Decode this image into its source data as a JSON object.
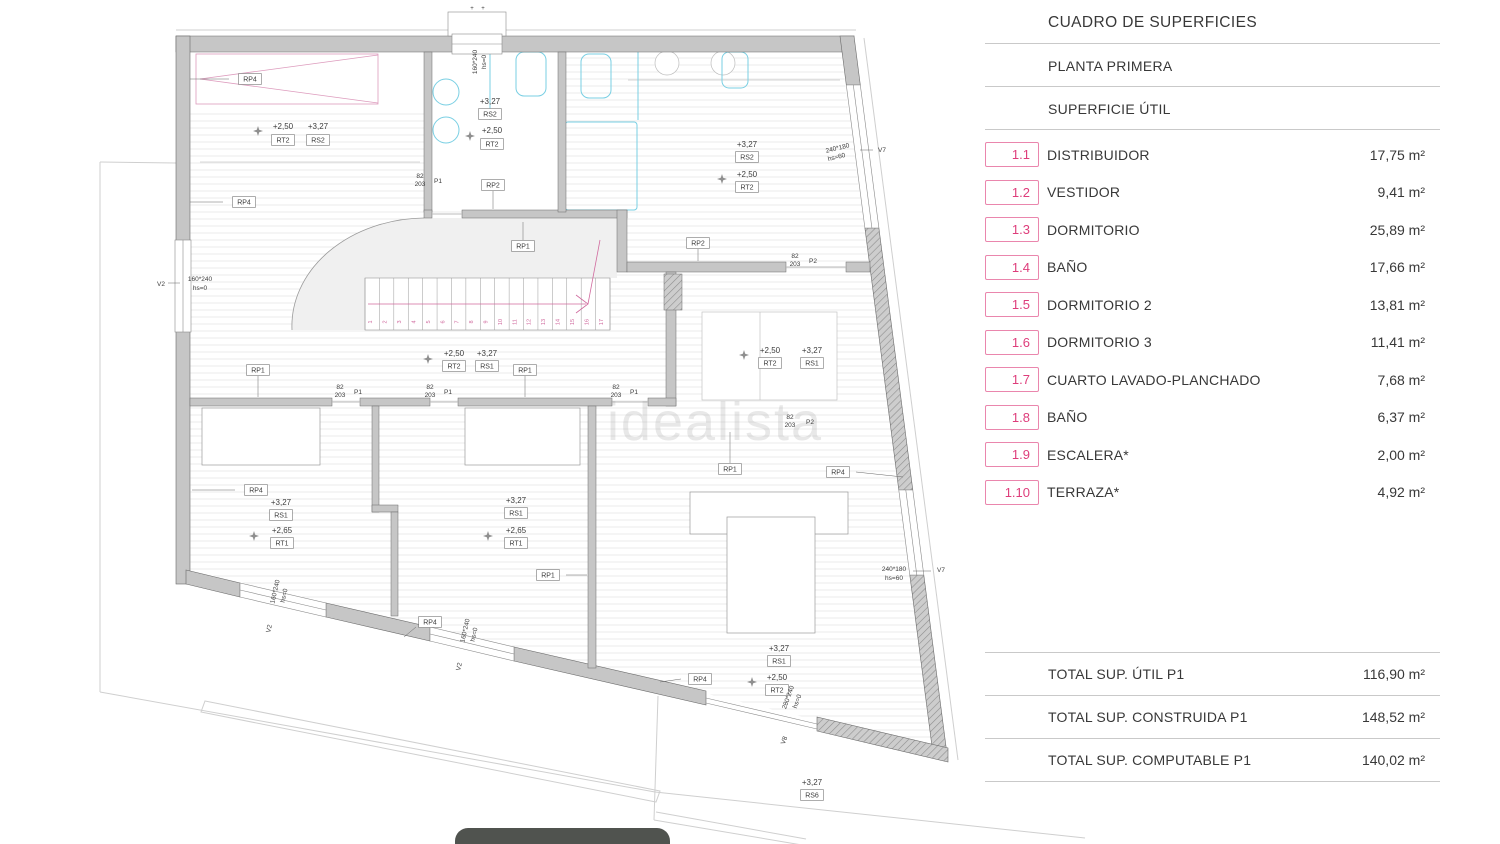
{
  "panel": {
    "title": "CUADRO DE SUPERFICIES",
    "subtitle": "PLANTA PRIMERA",
    "section": "SUPERFICIE ÚTIL",
    "accent_color": "#de3d7b",
    "rows": [
      {
        "code": "1.1",
        "label": "DISTRIBUIDOR",
        "value": "17,75 m²"
      },
      {
        "code": "1.2",
        "label": "VESTIDOR",
        "value": "9,41 m²"
      },
      {
        "code": "1.3",
        "label": "DORMITORIO",
        "value": "25,89 m²"
      },
      {
        "code": "1.4",
        "label": "BAÑO",
        "value": "17,66 m²"
      },
      {
        "code": "1.5",
        "label": "DORMITORIO 2",
        "value": "13,81 m²"
      },
      {
        "code": "1.6",
        "label": "DORMITORIO 3",
        "value": "11,41 m²"
      },
      {
        "code": "1.7",
        "label": "CUARTO LAVADO-PLANCHADO",
        "value": "7,68 m²"
      },
      {
        "code": "1.8",
        "label": "BAÑO",
        "value": "6,37 m²"
      },
      {
        "code": "1.9",
        "label": "ESCALERA*",
        "value": "2,00 m²"
      },
      {
        "code": "1.10",
        "label": "TERRAZA*",
        "value": "4,92 m²"
      }
    ],
    "totals": [
      {
        "label": "TOTAL SUP. ÚTIL P1",
        "value": "116,90 m²"
      },
      {
        "label": "TOTAL SUP. CONSTRUIDA P1",
        "value": "148,52 m²"
      },
      {
        "label": "TOTAL SUP. COMPUTABLE P1",
        "value": "140,02 m²"
      }
    ]
  },
  "plan": {
    "watermark": "idealista",
    "stairs": {
      "numbers": [
        1,
        2,
        3,
        4,
        5,
        6,
        7,
        8,
        9,
        10,
        11,
        12,
        13,
        14,
        15,
        16,
        17
      ]
    },
    "boxes": [
      {
        "t": "RP4",
        "x": 250,
        "y": 79
      },
      {
        "t": "RP4",
        "x": 244,
        "y": 202
      },
      {
        "t": "RP4",
        "x": 256,
        "y": 490
      },
      {
        "t": "RP4",
        "x": 700,
        "y": 679
      },
      {
        "t": "RP4",
        "x": 838,
        "y": 472
      },
      {
        "t": "RP4",
        "x": 430,
        "y": 622
      },
      {
        "t": "RP1",
        "x": 523,
        "y": 246
      },
      {
        "t": "RP1",
        "x": 258,
        "y": 370
      },
      {
        "t": "RP1",
        "x": 525,
        "y": 370
      },
      {
        "t": "RP1",
        "x": 548,
        "y": 575
      },
      {
        "t": "RP1",
        "x": 730,
        "y": 469
      },
      {
        "t": "RP2",
        "x": 493,
        "y": 185
      },
      {
        "t": "RP2",
        "x": 698,
        "y": 243
      },
      {
        "t": "RT2",
        "x": 283,
        "y": 140
      },
      {
        "t": "RT2",
        "x": 492,
        "y": 144
      },
      {
        "t": "RT2",
        "x": 747,
        "y": 187
      },
      {
        "t": "RT2",
        "x": 454,
        "y": 366
      },
      {
        "t": "RT2",
        "x": 770,
        "y": 363
      },
      {
        "t": "RT2",
        "x": 777,
        "y": 690
      },
      {
        "t": "RS2",
        "x": 318,
        "y": 140
      },
      {
        "t": "RS2",
        "x": 490,
        "y": 114
      },
      {
        "t": "RS2",
        "x": 747,
        "y": 157
      },
      {
        "t": "RS1",
        "x": 487,
        "y": 366
      },
      {
        "t": "RS1",
        "x": 812,
        "y": 363
      },
      {
        "t": "RS1",
        "x": 281,
        "y": 515
      },
      {
        "t": "RS1",
        "x": 516,
        "y": 513
      },
      {
        "t": "RS1",
        "x": 779,
        "y": 661
      },
      {
        "t": "RT1",
        "x": 282,
        "y": 543
      },
      {
        "t": "RT1",
        "x": 516,
        "y": 543
      },
      {
        "t": "RS6",
        "x": 812,
        "y": 795
      }
    ],
    "texts": [
      {
        "t": "+2,50",
        "x": 283,
        "y": 129
      },
      {
        "t": "+2,50",
        "x": 492,
        "y": 133
      },
      {
        "t": "+2,50",
        "x": 747,
        "y": 177
      },
      {
        "t": "+2,50",
        "x": 454,
        "y": 356
      },
      {
        "t": "+2,50",
        "x": 770,
        "y": 353
      },
      {
        "t": "+2,50",
        "x": 777,
        "y": 680
      },
      {
        "t": "+3,27",
        "x": 318,
        "y": 129
      },
      {
        "t": "+3,27",
        "x": 490,
        "y": 104
      },
      {
        "t": "+3,27",
        "x": 747,
        "y": 147
      },
      {
        "t": "+3,27",
        "x": 487,
        "y": 356
      },
      {
        "t": "+3,27",
        "x": 812,
        "y": 353
      },
      {
        "t": "+3,27",
        "x": 281,
        "y": 505
      },
      {
        "t": "+3,27",
        "x": 516,
        "y": 503
      },
      {
        "t": "+3,27",
        "x": 779,
        "y": 651
      },
      {
        "t": "+3,27",
        "x": 812,
        "y": 785
      },
      {
        "t": "+2,65",
        "x": 282,
        "y": 533
      },
      {
        "t": "+2,65",
        "x": 516,
        "y": 533
      },
      {
        "t": "82",
        "x": 420,
        "y": 178,
        "s": 6.5
      },
      {
        "t": "203",
        "x": 420,
        "y": 186,
        "s": 6.5
      },
      {
        "t": "P1",
        "x": 438,
        "y": 183,
        "s": 6.5
      },
      {
        "t": "82",
        "x": 340,
        "y": 389,
        "s": 6.5
      },
      {
        "t": "203",
        "x": 340,
        "y": 397,
        "s": 6.5
      },
      {
        "t": "P1",
        "x": 358,
        "y": 394,
        "s": 6.5
      },
      {
        "t": "82",
        "x": 430,
        "y": 389,
        "s": 6.5
      },
      {
        "t": "203",
        "x": 430,
        "y": 397,
        "s": 6.5
      },
      {
        "t": "P1",
        "x": 448,
        "y": 394,
        "s": 6.5
      },
      {
        "t": "82",
        "x": 616,
        "y": 389,
        "s": 6.5
      },
      {
        "t": "203",
        "x": 616,
        "y": 397,
        "s": 6.5
      },
      {
        "t": "P1",
        "x": 634,
        "y": 394,
        "s": 6.5
      },
      {
        "t": "82",
        "x": 795,
        "y": 258,
        "s": 6.5
      },
      {
        "t": "203",
        "x": 795,
        "y": 266,
        "s": 6.5
      },
      {
        "t": "P2",
        "x": 813,
        "y": 263,
        "s": 6.5
      },
      {
        "t": "82",
        "x": 790,
        "y": 419,
        "s": 6.5
      },
      {
        "t": "203",
        "x": 790,
        "y": 427,
        "s": 6.5
      },
      {
        "t": "P2",
        "x": 810,
        "y": 424,
        "s": 6.5
      },
      {
        "t": "160*240",
        "x": 477,
        "y": 62,
        "r": -90,
        "s": 6.5
      },
      {
        "t": "hs=0",
        "x": 486,
        "y": 62,
        "r": -90,
        "s": 6.5
      },
      {
        "t": "160*240",
        "x": 200,
        "y": 281,
        "s": 6.5
      },
      {
        "t": "hs=0",
        "x": 200,
        "y": 290,
        "s": 6.5
      },
      {
        "t": "V2",
        "x": 161,
        "y": 286,
        "s": 6.5
      },
      {
        "t": "160*240",
        "x": 277,
        "y": 592,
        "r": -77,
        "s": 6.5
      },
      {
        "t": "hs=0",
        "x": 286,
        "y": 596,
        "r": -77,
        "s": 6.5
      },
      {
        "t": "V2",
        "x": 271,
        "y": 629,
        "r": -77,
        "s": 6.5
      },
      {
        "t": "160*240",
        "x": 467,
        "y": 631,
        "r": -77,
        "s": 6.5
      },
      {
        "t": "hs=0",
        "x": 476,
        "y": 635,
        "r": -77,
        "s": 6.5
      },
      {
        "t": "V2",
        "x": 461,
        "y": 667,
        "r": -77,
        "s": 6.5
      },
      {
        "t": "240*180",
        "x": 838,
        "y": 150,
        "r": -14,
        "s": 6.5
      },
      {
        "t": "hs=60",
        "x": 837,
        "y": 159,
        "r": -14,
        "s": 6.5
      },
      {
        "t": "V7",
        "x": 882,
        "y": 152,
        "s": 6.5
      },
      {
        "t": "240*180",
        "x": 894,
        "y": 571,
        "s": 6.5
      },
      {
        "t": "hs=60",
        "x": 894,
        "y": 580,
        "s": 6.5
      },
      {
        "t": "V7",
        "x": 941,
        "y": 572,
        "s": 6.5
      },
      {
        "t": "280*240",
        "x": 790,
        "y": 698,
        "r": -70,
        "s": 6.5
      },
      {
        "t": "hs=0",
        "x": 799,
        "y": 702,
        "r": -70,
        "s": 6.5
      },
      {
        "t": "V8",
        "x": 786,
        "y": 741,
        "r": -70,
        "s": 6.5
      },
      {
        "t": "+",
        "x": 472,
        "y": 10,
        "s": 6
      },
      {
        "t": "+",
        "x": 483,
        "y": 10,
        "s": 6
      }
    ],
    "stars": [
      [
        258,
        131
      ],
      [
        470,
        136
      ],
      [
        722,
        179
      ],
      [
        428,
        359
      ],
      [
        744,
        355
      ],
      [
        254,
        536
      ],
      [
        488,
        536
      ],
      [
        752,
        682
      ]
    ]
  }
}
